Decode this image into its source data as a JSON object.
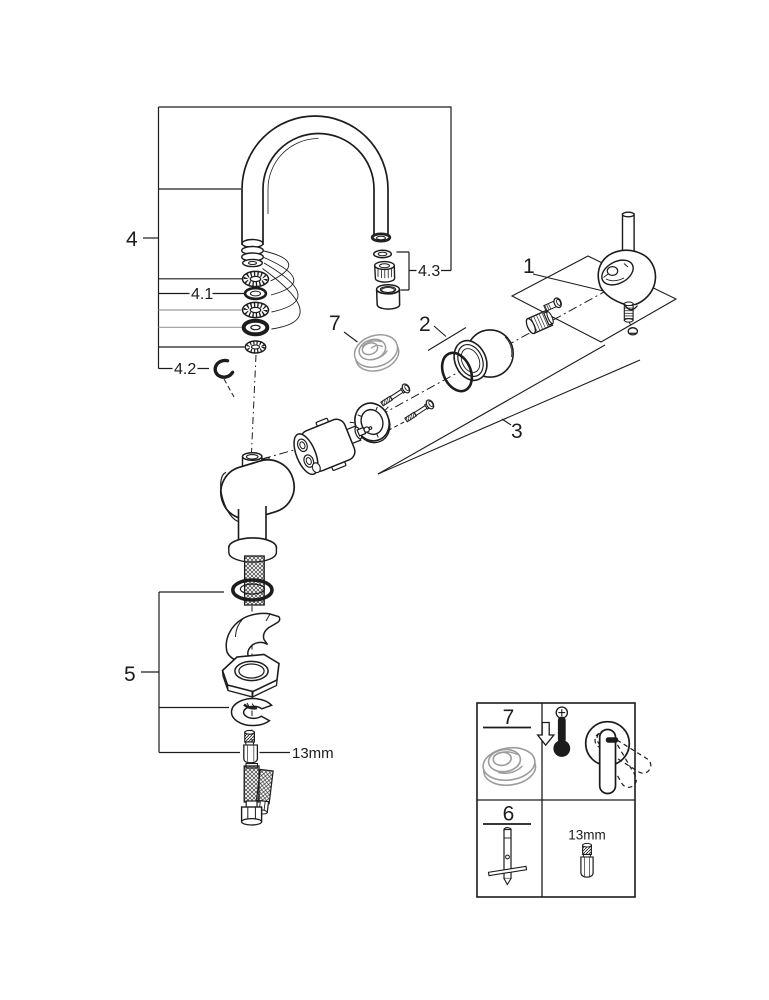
{
  "colors": {
    "ink": "#1c1c1c",
    "gray": "#9c9c9c",
    "background": "#ffffff"
  },
  "callouts": {
    "part_1": "1",
    "part_2": "2",
    "part_3": "3",
    "part_4": "4",
    "part_4_1": "4.1",
    "part_4_2": "4.2",
    "part_4_3": "4.3",
    "part_5": "5",
    "part_7": "7",
    "wrench_size": "13mm"
  },
  "legend": {
    "temperature_limiter": {
      "label": "7"
    },
    "mounting_tool": {
      "label": "6"
    },
    "stud_wrench_size": "13mm",
    "icons": [
      "temperature-limiter-ring-icon",
      "thermometer-minus-icon",
      "down-arrow-icon",
      "lever-handle-icon",
      "mounting-tool-icon",
      "threaded-stud-icon"
    ]
  }
}
